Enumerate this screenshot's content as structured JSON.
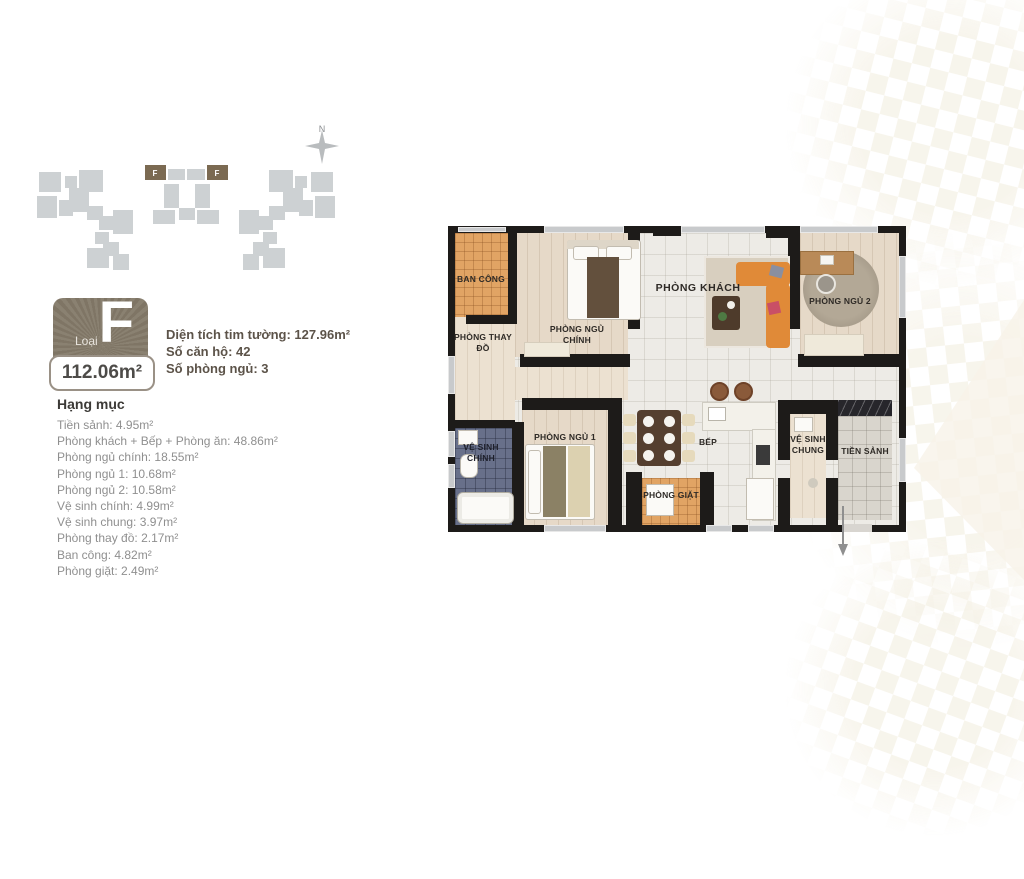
{
  "site_map": {
    "compass_label": "N",
    "unit_marker": "F"
  },
  "badge": {
    "type_label": "Loại",
    "type_letter": "F",
    "area": "112.06m²"
  },
  "info": {
    "line1": "Diện tích tim tường: 127.96m²",
    "line2": "Số căn hộ: 42",
    "line3": "Số phòng ngủ: 3"
  },
  "categories": {
    "heading": "Hạng mục",
    "items": [
      "Tiền sảnh: 4.95m²",
      "Phòng khách + Bếp + Phòng ăn: 48.86m²",
      "Phòng ngủ chính: 18.55m²",
      "Phòng ngủ 1: 10.68m²",
      "Phòng ngủ 2: 10.58m²",
      "Vệ sinh chính: 4.99m²",
      "Vệ sinh chung: 3.97m²",
      "Phòng thay đồ: 2.17m²",
      "Ban công: 4.82m²",
      "Phòng giặt: 2.49m²"
    ]
  },
  "plan": {
    "rooms": {
      "balcony": "BAN CÔNG",
      "dressing": "PHÒNG THAY ĐỒ",
      "master_bedroom": "PHÒNG NGỦ CHÍNH",
      "living": "PHÒNG KHÁCH",
      "bedroom2": "PHÒNG NGỦ 2",
      "master_bath": "VỆ SINH CHÍNH",
      "bedroom1": "PHÒNG NGỦ 1",
      "kitchen": "BẾP",
      "laundry": "PHÒNG GIẶT",
      "common_bath": "VỆ SINH CHUNG",
      "foyer": "TIỀN SẢNH"
    }
  },
  "colors": {
    "badge_brown": "#837968",
    "marker_brown": "#7b6a52",
    "building_gray": "#cdd1d3",
    "wall_black": "#1d1b19",
    "balcony_tile": "#e1a464",
    "bath_tile": "#68708a",
    "sofa_orange": "#e08a38",
    "wood_floor": "#e6d9c8"
  }
}
